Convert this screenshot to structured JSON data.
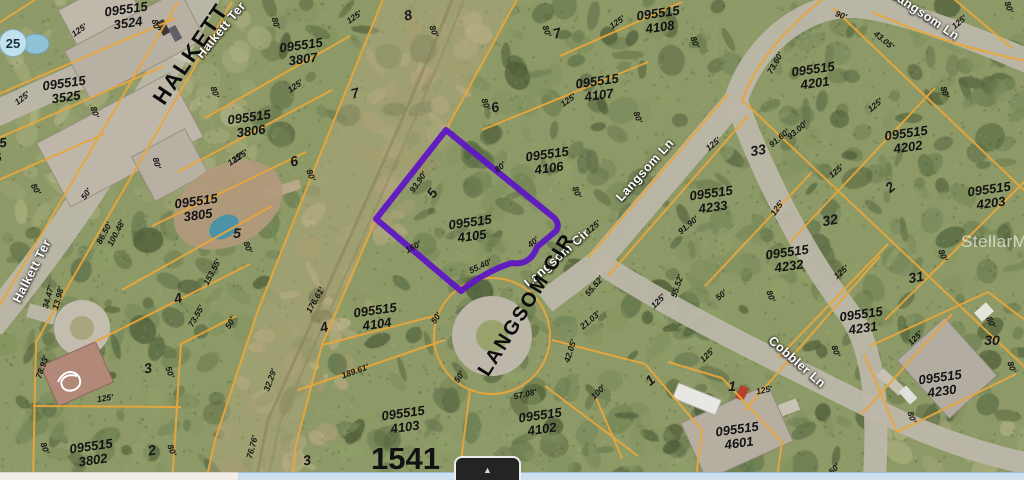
{
  "map_view": {
    "watermark": "StellarMLS",
    "big_parcel_number": "1541",
    "marker_bubble": "25",
    "highlighted_parcel_id": "095515 4105",
    "colors": {
      "parcel_line": "#E8A63C",
      "highlight": "#5E17C4",
      "road": "#BDB7A9"
    },
    "parcels": [
      {
        "label": "095515 3524",
        "x": 127,
        "y": 16,
        "r": -8
      },
      {
        "label": "095515 3525",
        "x": 65,
        "y": 90,
        "r": -8
      },
      {
        "label": "095515 3526",
        "x": -14,
        "y": 152,
        "r": -8
      },
      {
        "label": "095515 3807",
        "x": 302,
        "y": 52,
        "r": -8
      },
      {
        "label": "095515 3806",
        "x": 250,
        "y": 124,
        "r": -8
      },
      {
        "label": "095515 3805",
        "x": 197,
        "y": 208,
        "r": -8
      },
      {
        "label": "095515 3802",
        "x": 92,
        "y": 453,
        "r": -8
      },
      {
        "label": "095515 4108",
        "x": 659,
        "y": 20,
        "r": -8
      },
      {
        "label": "095515 4107",
        "x": 598,
        "y": 88,
        "r": -8
      },
      {
        "label": "095515 4106",
        "x": 548,
        "y": 161,
        "r": -8
      },
      {
        "label": "095515 4105",
        "x": 471,
        "y": 229,
        "r": -8
      },
      {
        "label": "095515 4104",
        "x": 376,
        "y": 317,
        "r": -8
      },
      {
        "label": "095515 4103",
        "x": 404,
        "y": 420,
        "r": -8
      },
      {
        "label": "095515 4102",
        "x": 541,
        "y": 422,
        "r": -8
      },
      {
        "label": "095515 4201",
        "x": 814,
        "y": 76,
        "r": -8
      },
      {
        "label": "095515 4202",
        "x": 907,
        "y": 140,
        "r": -8
      },
      {
        "label": "095515 4203",
        "x": 990,
        "y": 196,
        "r": -8
      },
      {
        "label": "095515 4233",
        "x": 712,
        "y": 200,
        "r": -8
      },
      {
        "label": "095515 4232",
        "x": 788,
        "y": 259,
        "r": -8
      },
      {
        "label": "095515 4231",
        "x": 862,
        "y": 321,
        "r": -8
      },
      {
        "label": "095515 4230",
        "x": 941,
        "y": 384,
        "r": -8
      },
      {
        "label": "095515 4601",
        "x": 738,
        "y": 436,
        "r": -8
      }
    ],
    "lot_numbers": [
      {
        "t": "8",
        "x": 408,
        "y": 15,
        "r": -15
      },
      {
        "t": "7",
        "x": 557,
        "y": 33,
        "r": -15
      },
      {
        "t": "7",
        "x": 355,
        "y": 93,
        "r": -15
      },
      {
        "t": "6",
        "x": 495,
        "y": 107,
        "r": -15
      },
      {
        "t": "6",
        "x": 294,
        "y": 161,
        "r": -15
      },
      {
        "t": "5",
        "x": 432,
        "y": 193,
        "r": -55
      },
      {
        "t": "5",
        "x": 237,
        "y": 233,
        "r": 0
      },
      {
        "t": "4",
        "x": 178,
        "y": 298,
        "r": -15
      },
      {
        "t": "4",
        "x": 324,
        "y": 327,
        "r": -15
      },
      {
        "t": "3",
        "x": 148,
        "y": 368,
        "r": -10
      },
      {
        "t": "2",
        "x": 152,
        "y": 450,
        "r": -10
      },
      {
        "t": "3",
        "x": 307,
        "y": 460,
        "r": -10
      },
      {
        "t": "33",
        "x": 758,
        "y": 150,
        "r": -10
      },
      {
        "t": "32",
        "x": 830,
        "y": 220,
        "r": -10
      },
      {
        "t": "31",
        "x": 916,
        "y": 277,
        "r": -10
      },
      {
        "t": "2",
        "x": 890,
        "y": 187,
        "r": -40
      },
      {
        "t": "30",
        "x": 992,
        "y": 340,
        "r": 0
      },
      {
        "t": "1",
        "x": 732,
        "y": 386,
        "r": 0
      },
      {
        "t": "1",
        "x": 650,
        "y": 380,
        "r": -40
      }
    ],
    "dimensions": [
      {
        "t": "125'",
        "x": 79,
        "y": 30,
        "r": -35
      },
      {
        "t": "80'",
        "x": 156,
        "y": 25,
        "r": 75
      },
      {
        "t": "80'",
        "x": 276,
        "y": 23,
        "r": 75
      },
      {
        "t": "125'",
        "x": 22,
        "y": 98,
        "r": -38
      },
      {
        "t": "80'",
        "x": 95,
        "y": 112,
        "r": 72
      },
      {
        "t": "125'",
        "x": 295,
        "y": 86,
        "r": -35
      },
      {
        "t": "80'",
        "x": 215,
        "y": 92,
        "r": 72
      },
      {
        "t": "125'",
        "x": 240,
        "y": 156,
        "r": -35
      },
      {
        "t": "80'",
        "x": 157,
        "y": 163,
        "r": 75
      },
      {
        "t": "125'",
        "x": 354,
        "y": 17,
        "r": -35
      },
      {
        "t": "80'",
        "x": 434,
        "y": 31,
        "r": 70
      },
      {
        "t": "125'",
        "x": 617,
        "y": 22,
        "r": -35
      },
      {
        "t": "80'",
        "x": 547,
        "y": 31,
        "r": 70
      },
      {
        "t": "80'",
        "x": 486,
        "y": 104,
        "r": 70
      },
      {
        "t": "125'",
        "x": 568,
        "y": 100,
        "r": -35
      },
      {
        "t": "80'",
        "x": 638,
        "y": 117,
        "r": 70
      },
      {
        "t": "90'",
        "x": 841,
        "y": 15,
        "r": 20
      },
      {
        "t": "43.05'",
        "x": 884,
        "y": 40,
        "r": 40
      },
      {
        "t": "80'",
        "x": 695,
        "y": 42,
        "r": 70
      },
      {
        "t": "73.60'",
        "x": 775,
        "y": 63,
        "r": -60
      },
      {
        "t": "80'",
        "x": 945,
        "y": 92,
        "r": 70
      },
      {
        "t": "125'",
        "x": 875,
        "y": 105,
        "r": -40
      },
      {
        "t": "93.00'",
        "x": 797,
        "y": 130,
        "r": -40
      },
      {
        "t": "91.60'",
        "x": 779,
        "y": 138,
        "r": -40
      },
      {
        "t": "125'",
        "x": 713,
        "y": 144,
        "r": -40
      },
      {
        "t": "93.90'",
        "x": 418,
        "y": 182,
        "r": -55
      },
      {
        "t": "80'",
        "x": 500,
        "y": 167,
        "r": -40
      },
      {
        "t": "80'",
        "x": 577,
        "y": 192,
        "r": 70
      },
      {
        "t": "125'",
        "x": 593,
        "y": 227,
        "r": -40
      },
      {
        "t": "40'",
        "x": 533,
        "y": 242,
        "r": -40
      },
      {
        "t": "160'",
        "x": 413,
        "y": 247,
        "r": -28
      },
      {
        "t": "55.40'",
        "x": 480,
        "y": 266,
        "r": -25
      },
      {
        "t": "91.90'",
        "x": 688,
        "y": 225,
        "r": -40
      },
      {
        "t": "125'",
        "x": 777,
        "y": 208,
        "r": -55
      },
      {
        "t": "50'",
        "x": 721,
        "y": 295,
        "r": -40
      },
      {
        "t": "80'",
        "x": 771,
        "y": 296,
        "r": 70
      },
      {
        "t": "125'",
        "x": 836,
        "y": 171,
        "r": -40
      },
      {
        "t": "125'",
        "x": 841,
        "y": 272,
        "r": -40
      },
      {
        "t": "80'",
        "x": 943,
        "y": 255,
        "r": 70
      },
      {
        "t": "125'",
        "x": 658,
        "y": 301,
        "r": -45
      },
      {
        "t": "125'",
        "x": 235,
        "y": 159,
        "r": -35
      },
      {
        "t": "80'",
        "x": 311,
        "y": 175,
        "r": 70
      },
      {
        "t": "50'",
        "x": 86,
        "y": 194,
        "r": -55
      },
      {
        "t": "86.50'",
        "x": 104,
        "y": 233,
        "r": -62
      },
      {
        "t": "100.48'",
        "x": 116,
        "y": 233,
        "r": -62
      },
      {
        "t": "80'",
        "x": 36,
        "y": 189,
        "r": 60
      },
      {
        "t": "80'",
        "x": 248,
        "y": 247,
        "r": 70
      },
      {
        "t": "153.55'",
        "x": 212,
        "y": 272,
        "r": -62
      },
      {
        "t": "34.47'",
        "x": 48,
        "y": 297,
        "r": -75
      },
      {
        "t": "13.98'",
        "x": 58,
        "y": 298,
        "r": -75
      },
      {
        "t": "176.61'",
        "x": 315,
        "y": 300,
        "r": -60
      },
      {
        "t": "78.93'",
        "x": 42,
        "y": 367,
        "r": -70
      },
      {
        "t": "125'",
        "x": 105,
        "y": 398,
        "r": -8
      },
      {
        "t": "80'",
        "x": 45,
        "y": 448,
        "r": 70
      },
      {
        "t": "73.55'",
        "x": 196,
        "y": 316,
        "r": -60
      },
      {
        "t": "50'",
        "x": 230,
        "y": 323,
        "r": -60
      },
      {
        "t": "32.29'",
        "x": 270,
        "y": 380,
        "r": -70
      },
      {
        "t": "76.76'",
        "x": 252,
        "y": 447,
        "r": -75
      },
      {
        "t": "50'",
        "x": 170,
        "y": 372,
        "r": 70
      },
      {
        "t": "80'",
        "x": 172,
        "y": 450,
        "r": 70
      },
      {
        "t": "189.61'",
        "x": 355,
        "y": 371,
        "r": -20
      },
      {
        "t": "50'",
        "x": 436,
        "y": 318,
        "r": -55
      },
      {
        "t": "50'",
        "x": 459,
        "y": 377,
        "r": -55
      },
      {
        "t": "57.08'",
        "x": 525,
        "y": 394,
        "r": -12
      },
      {
        "t": "21.03'",
        "x": 590,
        "y": 320,
        "r": -40
      },
      {
        "t": "42.05'",
        "x": 570,
        "y": 351,
        "r": -72
      },
      {
        "t": "55.52'",
        "x": 594,
        "y": 286,
        "r": -50
      },
      {
        "t": "55.52'",
        "x": 677,
        "y": 286,
        "r": -72
      },
      {
        "t": "100'",
        "x": 598,
        "y": 392,
        "r": -45
      },
      {
        "t": "125'",
        "x": 707,
        "y": 355,
        "r": -45
      },
      {
        "t": "125'",
        "x": 764,
        "y": 390,
        "r": -12
      },
      {
        "t": "80'",
        "x": 836,
        "y": 351,
        "r": 70
      },
      {
        "t": "125'",
        "x": 915,
        "y": 338,
        "r": -45
      },
      {
        "t": "80'",
        "x": 991,
        "y": 322,
        "r": 65
      },
      {
        "t": "80'",
        "x": 912,
        "y": 417,
        "r": 70
      },
      {
        "t": "50'",
        "x": 834,
        "y": 469,
        "r": -45
      },
      {
        "t": "80'",
        "x": 1012,
        "y": 367,
        "r": 70
      },
      {
        "t": "80'",
        "x": 1009,
        "y": 7,
        "r": 70
      },
      {
        "t": "125'",
        "x": 959,
        "y": 22,
        "r": -40
      }
    ],
    "street_labels_black": [
      {
        "t": "HALKETT",
        "x": 191,
        "y": 54,
        "r": -56,
        "size": 22
      },
      {
        "t": "LANGSOM CIR",
        "x": 527,
        "y": 305,
        "r": -58,
        "size": 20
      }
    ],
    "street_labels_white": [
      {
        "t": "Halkett Ter",
        "x": 221,
        "y": 30,
        "r": -50
      },
      {
        "t": "Halkett Ter",
        "x": 32,
        "y": 271,
        "r": -63
      },
      {
        "t": "Langsom Ln",
        "x": 925,
        "y": 15,
        "r": 34
      },
      {
        "t": "Langsom Ln",
        "x": 645,
        "y": 170,
        "r": -48
      },
      {
        "t": "Langsom Cir",
        "x": 557,
        "y": 258,
        "r": -41
      },
      {
        "t": "Cobbler Ln",
        "x": 797,
        "y": 362,
        "r": 41
      }
    ]
  },
  "footer": {
    "expander_icon": "▲"
  }
}
